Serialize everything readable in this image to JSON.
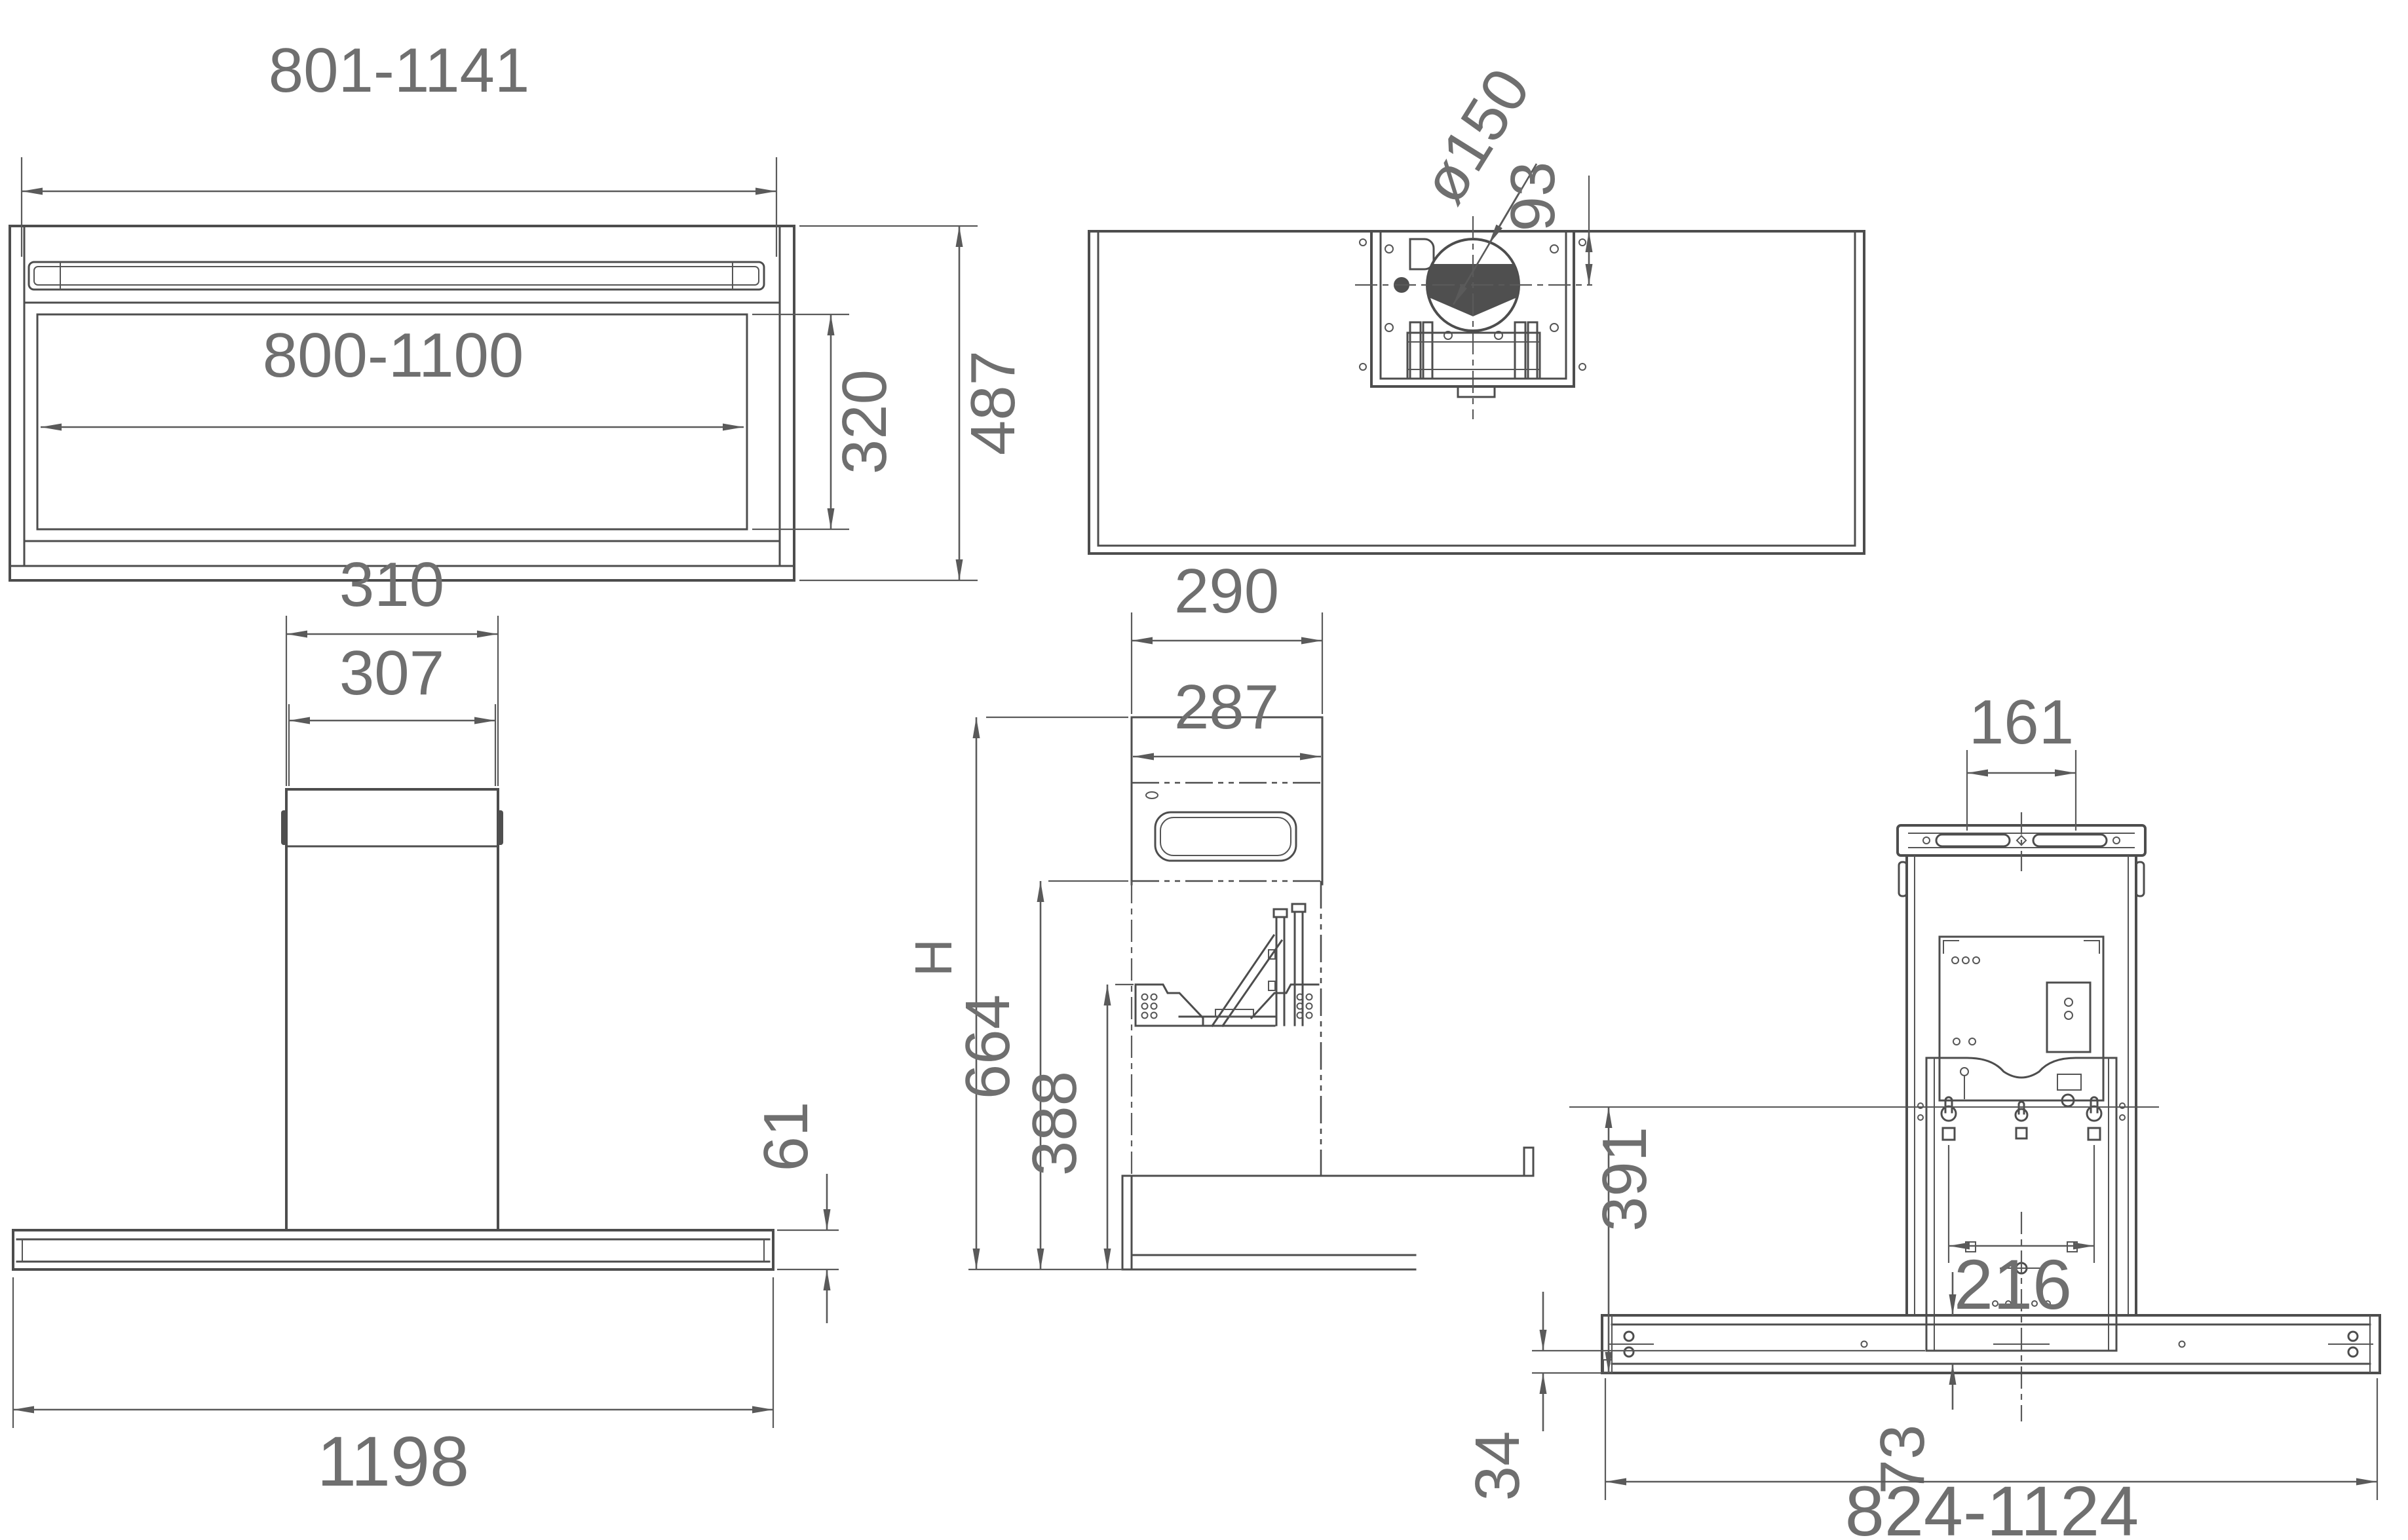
{
  "front_top": {
    "width_outer": "801-1141",
    "width_inner": "800-1100",
    "height_inner": "320",
    "height_overall": "487"
  },
  "top": {
    "duct_diameter": "ø150",
    "duct_offset": "93"
  },
  "front": {
    "chimney_outer": "310",
    "chimney_inner": "307",
    "canopy_height": "61",
    "canopy_width": "1198"
  },
  "side": {
    "depth_outer": "290",
    "depth_inner": "287",
    "height_label": "H",
    "height_mid": "664",
    "height_low": "388"
  },
  "rear": {
    "vent_spacing": "161",
    "keyhole_spacing": "216",
    "bracket_height": "391",
    "bottom_gap": "34",
    "body_offset": "73",
    "width_range": "824-1124"
  }
}
